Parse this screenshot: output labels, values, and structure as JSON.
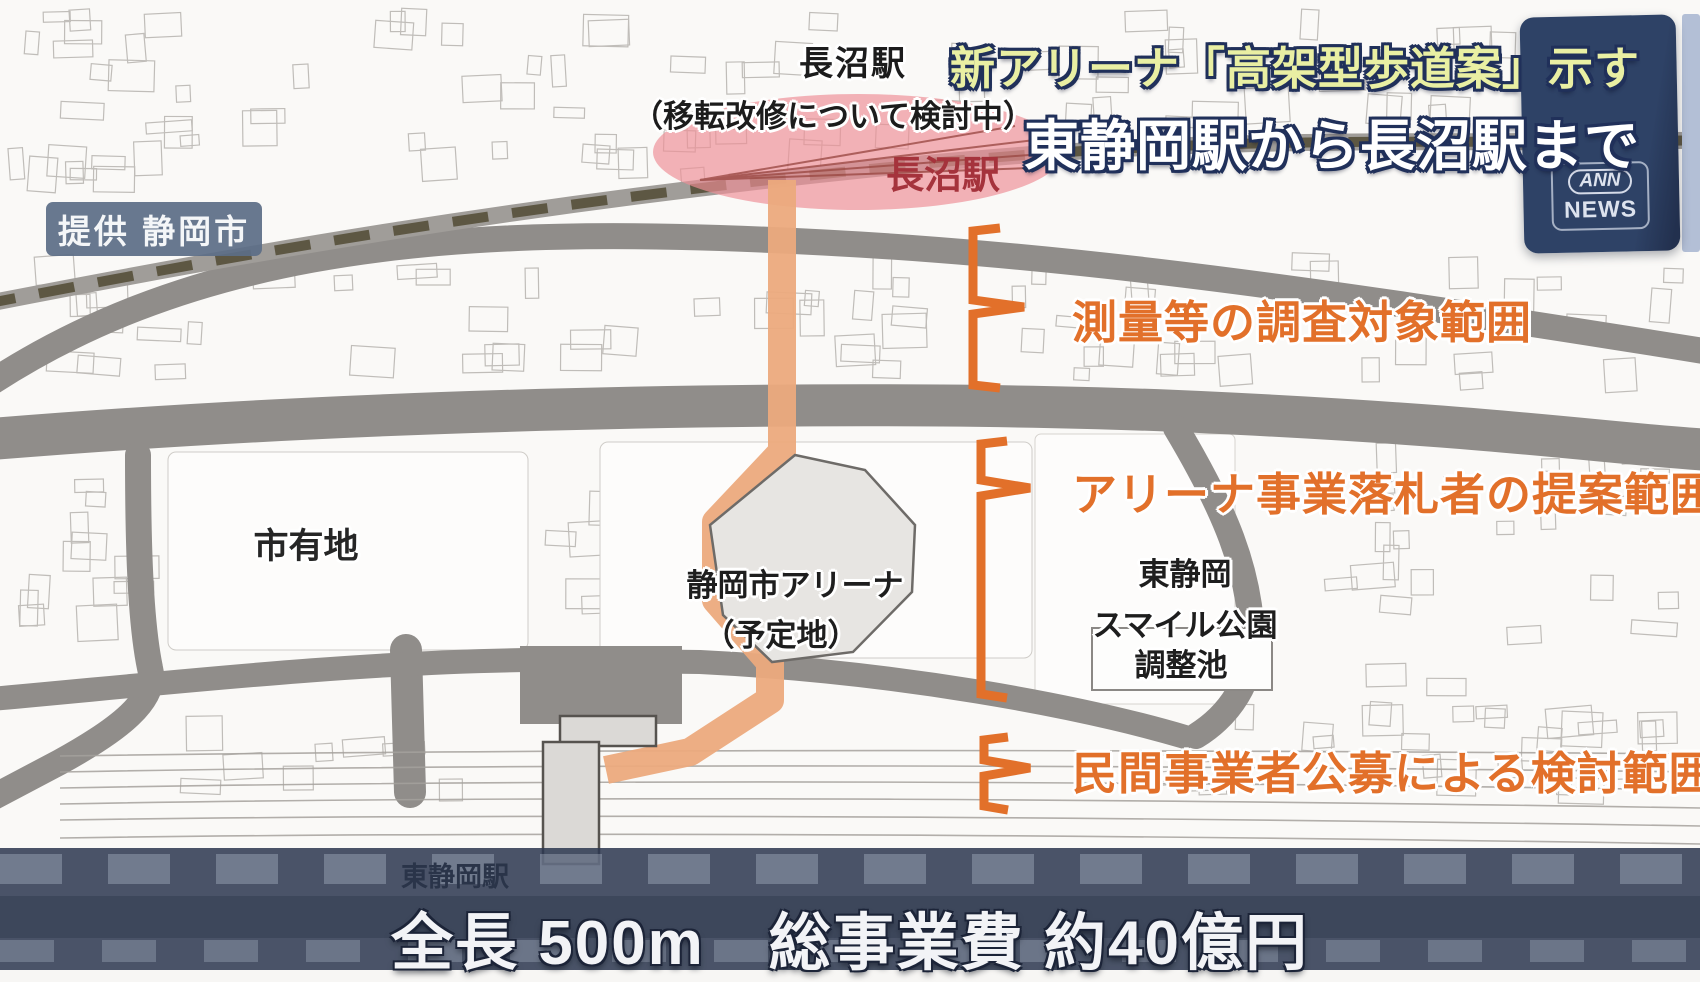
{
  "header": {
    "headline_line1": "新アリーナ「高架型歩道案」示す",
    "headline_line2": "東静岡駅から長沼駅まで"
  },
  "ann_panel": {
    "logo_top": "ANN",
    "logo_bottom": "NEWS"
  },
  "credit_badge": {
    "text": "提供 静岡市"
  },
  "map": {
    "naganuma_note_line1": "長沼駅",
    "naganuma_note_line2": "（移転改修について検討中）",
    "naganuma_station_label": "長沼駅",
    "city_land_label": "市有地",
    "arena_label_line1": "静岡市アリーナ",
    "arena_label_line2": "（予定地）",
    "park_label_line1": "東静岡",
    "park_label_line2": "スマイル公園",
    "pond_label": "調整池",
    "higashi_shizuoka_station_label": "東静岡駅"
  },
  "range_annotations": {
    "items": [
      {
        "label": "測量等の調査対象範囲"
      },
      {
        "label": "アリーナ事業落札者の提案範囲"
      },
      {
        "label": "民間事業者公募による検討範囲"
      }
    ]
  },
  "bottom_banner": {
    "text": "全長 500m　総事業費 約40億円"
  },
  "colors": {
    "annotation_orange": "#e2702a",
    "walkway_salmon": "#ecaa7d",
    "station_highlight_pink": "#ee8f96",
    "panel_navy": "#2e4266",
    "overlay_slate": "#2c3850",
    "headline_yellow": "#e9efa3"
  }
}
